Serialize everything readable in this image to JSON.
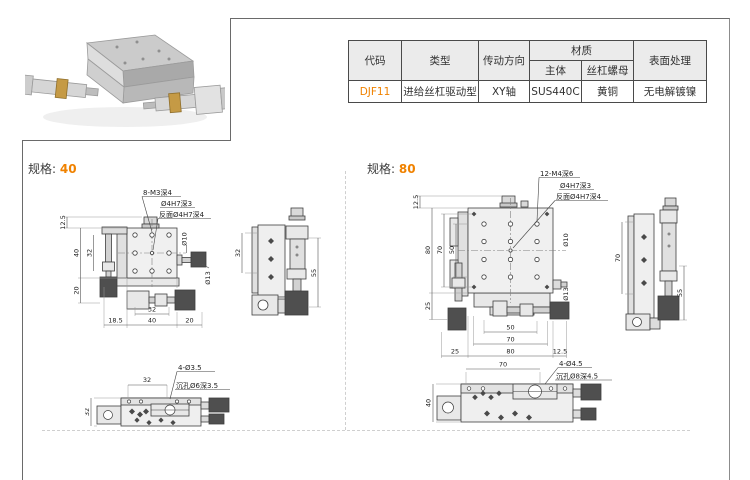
{
  "table": {
    "headers": {
      "code": "代码",
      "type": "类型",
      "direction": "传动方向",
      "material": "材质",
      "material_body": "主体",
      "material_nut": "丝杠螺母",
      "surface": "表面处理"
    },
    "row": {
      "code": "DJF11",
      "type": "进给丝杠驱动型",
      "direction": "XY轴",
      "material_body": "SUS440C",
      "material_nut": "黄铜",
      "surface": "无电解镀镍"
    }
  },
  "sections": {
    "spec_label": "规格:",
    "spec40": "40",
    "spec80": "80"
  },
  "drawing40": {
    "top": {
      "callout_holes": "8-M3深4",
      "callout_center_hole": "Ø4H7深3",
      "callout_center_back": "反面Ø4H7深4",
      "dim_height_offset": "12.5",
      "dim_body_h": "40",
      "dim_holes_v": "32",
      "dim_base_h": "20",
      "dim_holes_h": "32",
      "dim_left_overhang": "18.5",
      "dim_body_w": "40",
      "dim_right_overhang": "20",
      "dim_knob_small": "Ø10",
      "dim_knob_large": "Ø13"
    },
    "side": {
      "dim_holes": "32",
      "dim_height": "55"
    },
    "bottom": {
      "dim_holes": "32",
      "callout_holes": "4-Ø3.5",
      "callout_cbore": "沉孔Ø6深3.5",
      "dim_width": "32"
    }
  },
  "drawing80": {
    "top": {
      "callout_holes": "12-M4深6",
      "callout_center_hole": "Ø4H7深3",
      "callout_center_back": "反面Ø4H7深4",
      "dim_height_offset": "12.5",
      "dim_body_h": "80",
      "dim_mount_v": "70",
      "dim_holes_v": "50",
      "dim_base_h": "25",
      "dim_holes_h": "50",
      "dim_mount_h": "70",
      "dim_left_overhang": "25",
      "dim_body_w": "80",
      "dim_right_overhang": "12.5",
      "dim_knob_small": "Ø10",
      "dim_knob_large": "Ø13"
    },
    "side": {
      "dim_mount": "70",
      "dim_height": "55"
    },
    "bottom": {
      "dim_mount": "70",
      "callout_holes": "4-Ø4.5",
      "callout_cbore": "沉孔Ø8深4.5",
      "dim_width": "40"
    }
  },
  "colors": {
    "accent": "#f08200",
    "table_border": "#4a4a4a",
    "header_bg": "#ebebeb",
    "dashed_line": "#cfcfcf"
  }
}
